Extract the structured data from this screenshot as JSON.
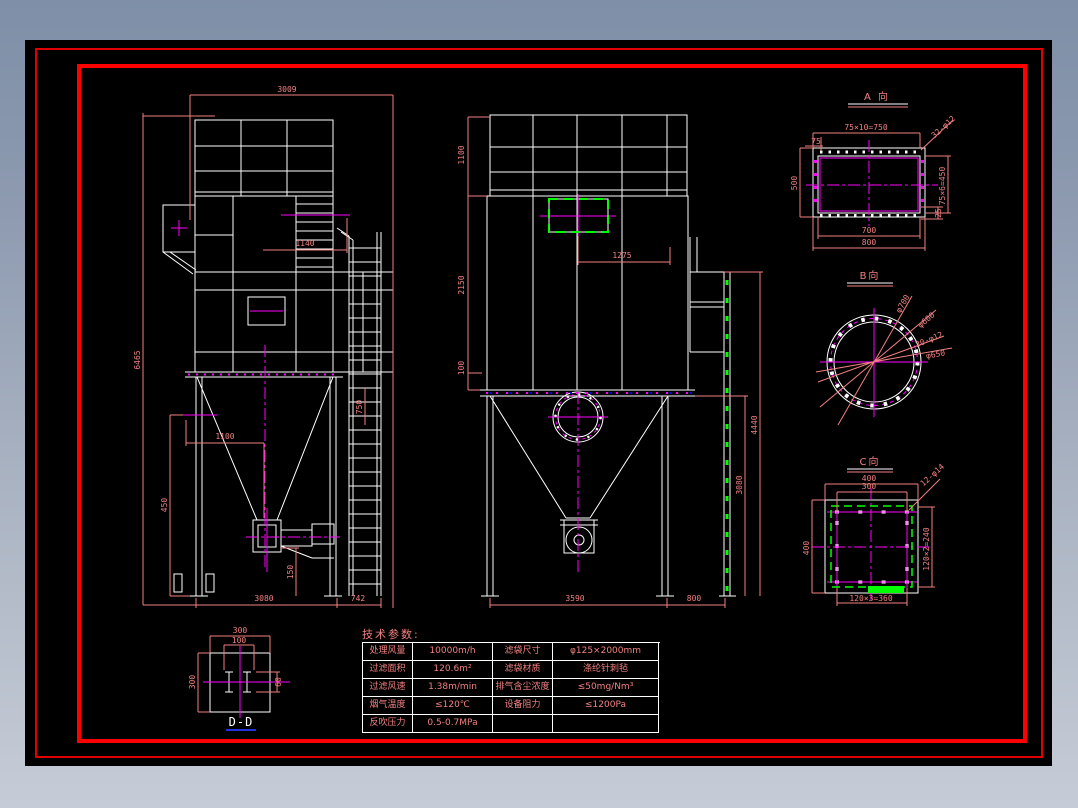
{
  "sheet": {
    "background": "#000000",
    "border_outer_color": "#e00000",
    "border_inner_color": "#ff0000",
    "line_color": "#ffffff",
    "centerline_color": "#ff00ff",
    "dimension_color": "#f28080",
    "highlight_color": "#00ff00"
  },
  "left_view": {
    "dim_overall_width": "3009",
    "dim_overall_height": "6465",
    "dim_1140": "1140",
    "dim_1100": "1100",
    "dim_450": "450",
    "dim_150": "150",
    "dim_750": "750",
    "dim_base_width": "3080",
    "dim_ladder_offset": "742"
  },
  "front_view": {
    "dim_top_height": "1100",
    "dim_body_height": "2150",
    "dim_100": "100",
    "dim_inlet_offset": "1275",
    "dim_leg_height": "3080",
    "dim_right_height": "4440",
    "dim_base_width": "3590",
    "dim_right_offset": "800"
  },
  "detail_a": {
    "title": "A 向",
    "dim_bolt_spacing_top": "75×10=750",
    "dim_75": "75",
    "holes": "32-φ12",
    "dim_opening_width": "700",
    "dim_flange_width": "800",
    "dim_left_height": "500",
    "dim_bolt_spacing_side": "75×6=450",
    "dim_25": "25"
  },
  "detail_b": {
    "title": "B向",
    "label_outer_dia": "φ700",
    "label_inner_dia": "φ600",
    "holes": "20-φ12",
    "label_bolt_circle": "φ650"
  },
  "detail_c": {
    "title": "C向",
    "dim_width": "400",
    "dim_opening": "300",
    "holes": "12-φ14",
    "dim_left_height": "400",
    "dim_bolt_spacing_side": "120×2=240",
    "dim_bolt_spacing_bottom": "120×3=360"
  },
  "detail_d": {
    "title": "D-D",
    "dim_width": "300",
    "dim_beam_spacing": "100",
    "dim_height": "300",
    "dim_beam": "60"
  },
  "table": {
    "title": "技术参数:",
    "rows": [
      [
        "处理风量",
        "10000m/h",
        "滤袋尺寸",
        "φ125×2000mm"
      ],
      [
        "过滤面积",
        "120.6m²",
        "滤袋材质",
        "涤纶针刺毡"
      ],
      [
        "过滤风速",
        "1.38m/min",
        "排气含尘浓度",
        "≤50mg/Nm³"
      ],
      [
        "烟气温度",
        "≤120℃",
        "设备阻力",
        "≤1200Pa"
      ],
      [
        "反吹压力",
        "0.5-0.7MPa",
        "",
        ""
      ]
    ]
  }
}
